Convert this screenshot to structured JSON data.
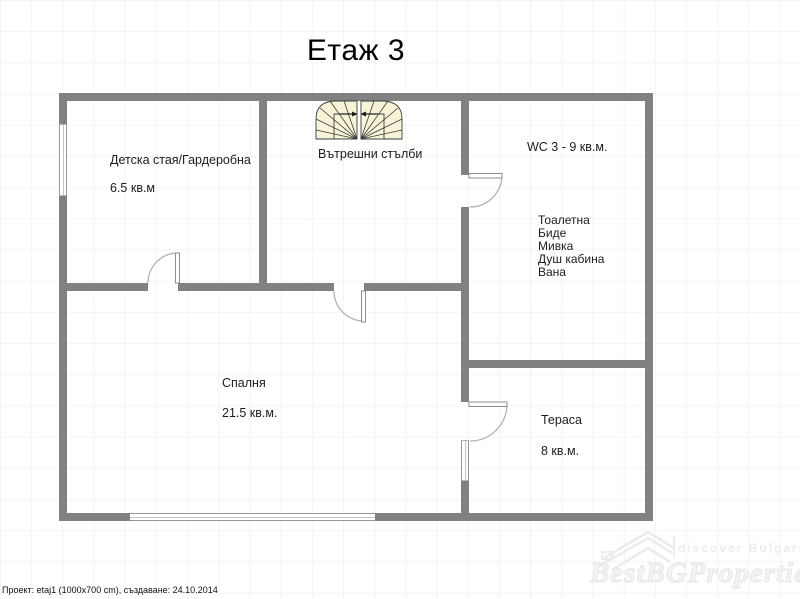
{
  "page": {
    "title": "Етаж 3"
  },
  "rooms": {
    "children": {
      "name": "Детска стая/Гардеробна",
      "area": "6.5 кв.м"
    },
    "stairs": {
      "name": "Вътрешни стълби"
    },
    "wc": {
      "name": "WC 3 - 9 кв.м.",
      "fixtures": [
        "Тоалетна",
        "Биде",
        "Мивка",
        "Душ кабина",
        "Вана"
      ]
    },
    "bedroom": {
      "name": "Спалня",
      "area": "21.5 кв.м."
    },
    "terrace": {
      "name": "Тераса",
      "area": "8 кв.м."
    }
  },
  "footer": {
    "project_info": "Проект: etaj1 (1000x700 cm), създаване: 24.10.2014"
  },
  "watermark": {
    "tagline": "discover Bulgaria",
    "brand": "BestBGProperties"
  },
  "colors": {
    "wall": "#818181",
    "stairs_fill": "#f6f3d6",
    "grid": "#f4f4f4",
    "text": "#000000",
    "watermark": "#ececec"
  }
}
